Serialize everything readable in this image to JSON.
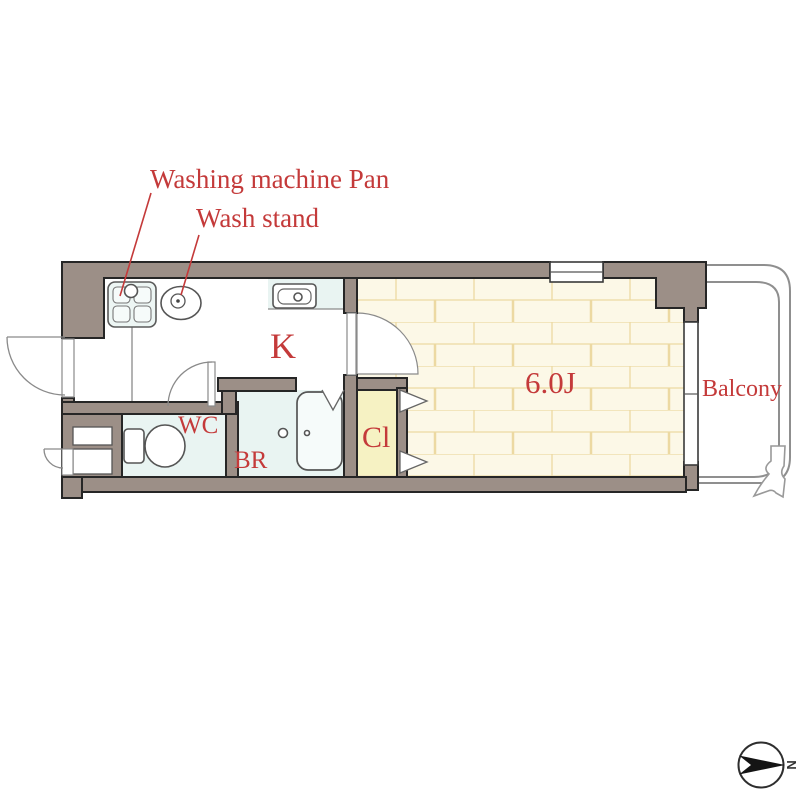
{
  "plan": {
    "type": "apartment-floor-plan",
    "rooms": [
      "kitchen",
      "main_room",
      "balcony",
      "toilet",
      "bathroom",
      "closet"
    ],
    "callouts": [
      "washing_machine_pan",
      "wash_stand"
    ],
    "compass": {
      "direction": "right"
    }
  },
  "labels": {
    "washing_machine_pan": "Washing machine Pan",
    "wash_stand": "Wash stand",
    "kitchen": "K",
    "main_room": "6.0J",
    "balcony": "Balcony",
    "toilet": "WC",
    "bathroom": "BR",
    "closet": "Cl",
    "compass_north": "N"
  },
  "colors": {
    "wall": "#9c8f87",
    "wall_outline": "#262626",
    "label_red": "#c43a3a",
    "room_6j_floor": "#fcf8e7",
    "brick_line": "#ecd9a2",
    "wet_room_floor": "#e9f4f2",
    "closet_floor": "#f6f2c3",
    "balcony_line": "#8f8f8f"
  }
}
